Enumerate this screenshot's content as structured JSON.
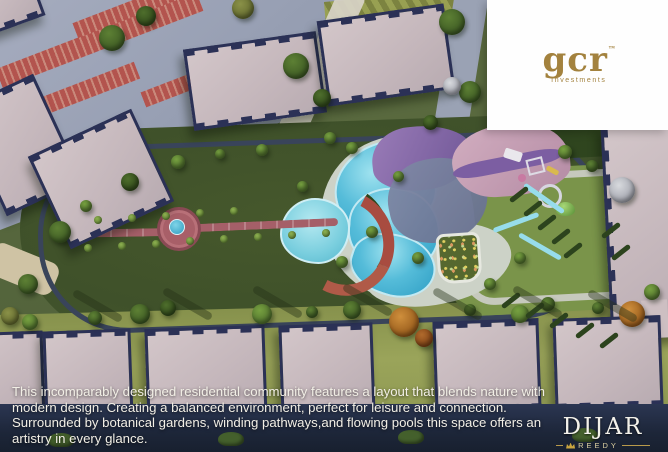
{
  "brand_panel": {
    "logo_text": "gcr",
    "trademark": "™",
    "tagline": "Investments"
  },
  "caption": {
    "lines": [
      "This incomparably designed residential community features a layout that blends nature with",
      "modern design. Creating a balanced environment, perfect for leisure and connection.",
      "Surrounded by botanical gardens, winding pathways,and flowing pools this space offers an",
      "artistry in every glance."
    ]
  },
  "footer_brand": {
    "name": "DIJAR",
    "sub_brand": "REEDY"
  },
  "colors": {
    "brand_gold": "#a3823e",
    "footer_gold": "#c9a43e",
    "caption_text": "#f2efe6",
    "lawn_green": "#556639",
    "park_green": "#42542b",
    "pool_blue": "#49b4d8",
    "roof_pink": "#c9bcc0",
    "roof_border_navy": "#2b3156",
    "walkway_pink": "#a55f68",
    "playground_purple": "#7c5ea2"
  }
}
